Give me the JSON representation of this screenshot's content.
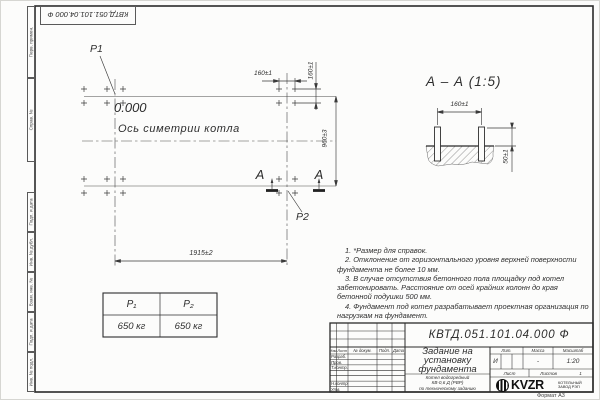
{
  "page": {
    "stamp_top": "КВТД.051.101.04.000  Ф",
    "format_label": "Формат А3",
    "margin_labels": [
      "Перв. примен.",
      "Справ. №",
      "Подп. и дата",
      "Инв. № дубл.",
      "Взам. инв. №",
      "Подп. и дата",
      "Инв. № подл."
    ]
  },
  "plan": {
    "p1_label": "P1",
    "p2_label": "P2",
    "elevation": "0.000",
    "axis_label": "Ось симетрии котла",
    "dim_width": "1915±2",
    "dim_height": "960±3",
    "dim_bolt_x": "160±1",
    "dim_bolt_y": "160±1",
    "section_letter_left": "А",
    "section_letter_right": "А"
  },
  "section": {
    "title": "А – А (1:5)",
    "dim_spacing": "160±1",
    "dim_protrusion": "50±1"
  },
  "notes": [
    "1. *Размер для справок.",
    "2. Отклонение от горизонтального уровня верхней поверхности фундамента не более 10 мм.",
    "3. В случае отсутствия бетонного пола площадку под котел забетонировать. Расстояние от осей крайних колонн до края бетонной подушки 500 мм.",
    "4. Фундамент под котел разрабатывает проектная организация по нагрузкам на фундамент."
  ],
  "load_table": {
    "headers": [
      "Р₁",
      "Р₂"
    ],
    "values": [
      "650 кг",
      "650 кг"
    ]
  },
  "title_block": {
    "doc_number": "КВТД.051.101.04.000  Ф",
    "title_lines": [
      "Задание на",
      "установку",
      "фундамента"
    ],
    "product_lines": [
      "Котел водогрейный",
      "КВ-0,6 Д (РВР)",
      "по техническому заданию"
    ],
    "header_cols": [
      "Изм.",
      "Лист",
      "№ докум.",
      "Подп.",
      "Дата"
    ],
    "rows": [
      "Разраб.",
      "Пров.",
      "Т.контр.",
      "Н.контр.",
      "Утв."
    ],
    "lit_label": "Лит.",
    "lit_value": "И",
    "mass_label": "Масса",
    "mass_value": "-",
    "scale_label": "Масштаб",
    "scale_value": "1:20",
    "sheet_label": "Лист",
    "sheets_label": "Листов",
    "sheets_value": "1",
    "logo_text": "KVZR",
    "company_lines": [
      "КОТЕЛЬНЫЙ",
      "ЗАВОД РЭП"
    ]
  }
}
